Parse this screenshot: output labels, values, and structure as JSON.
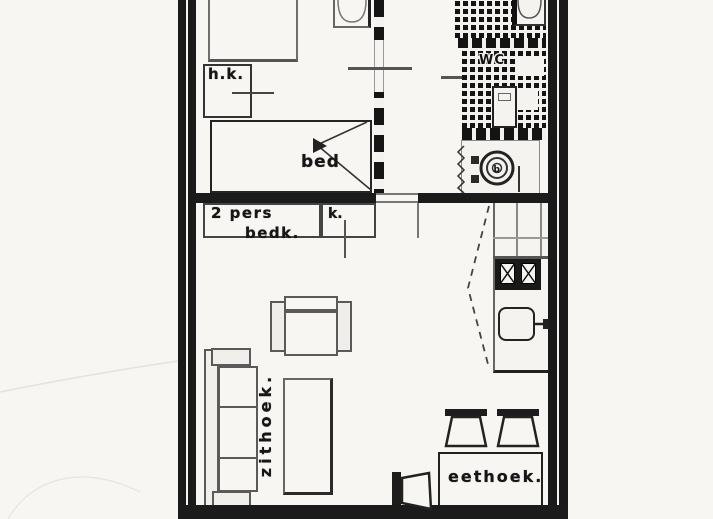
{
  "plan": {
    "type": "apartment-floor-plan",
    "style": "scanned black-and-white architectural drawing, cropped top and bottom",
    "labels": {
      "hanging_closet": "h.k.",
      "bed": "bed",
      "bedroom_line1": "2 pers",
      "bedroom_line2": "bedk.",
      "closet": "k.",
      "toilet_room": "WC",
      "boiler": "b",
      "sitting_area": "zithoek.",
      "dining_area": "eethoek."
    },
    "colors": {
      "background": "#f7f6f3",
      "wall": "#1b1b1b",
      "line": "#2a2a2a",
      "tile_dark": "#141414",
      "tile_gap": "#f2f1ee"
    }
  }
}
